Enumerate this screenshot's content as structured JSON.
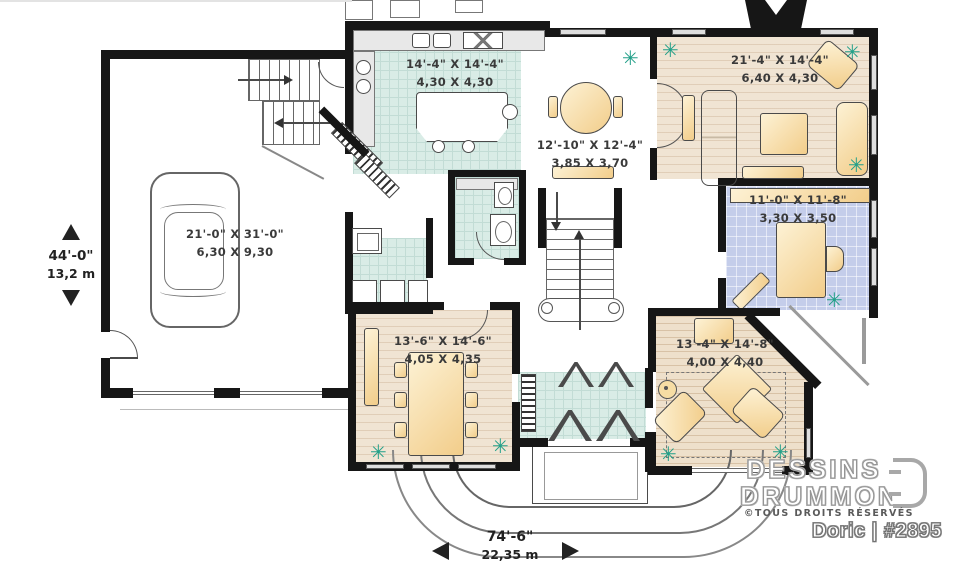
{
  "icons": {
    "plant": "✳"
  },
  "plan": {
    "rooms": [
      {
        "name": "garage",
        "imperial": "21'-0\" X 31'-0\"",
        "metric": "6,30 X 9,30"
      },
      {
        "name": "kitchen",
        "imperial": "14'-4\" X 14'-4\"",
        "metric": "4,30 X 4,30"
      },
      {
        "name": "breakfast",
        "imperial": "12'-10\" X 12'-4\"",
        "metric": "3,85 X 3,70"
      },
      {
        "name": "living",
        "imperial": "21'-4\" X 14'-4\"",
        "metric": "6,40 X 4,30"
      },
      {
        "name": "office",
        "imperial": "11'-0\" X 11'-8\"",
        "metric": "3,30 X 3,50"
      },
      {
        "name": "dining",
        "imperial": "13'-6\" X 14'-6\"",
        "metric": "4,05 X 4,35"
      },
      {
        "name": "family",
        "imperial": "13'-4\" X 14'-8\"",
        "metric": "4,00 X 4,40"
      }
    ],
    "overall": {
      "depth_imperial": "44'-0\"",
      "depth_metric": "13,2 m",
      "width_imperial": "74'-6\"",
      "width_metric": "22,35 m"
    }
  },
  "branding": {
    "brand_line1": "DESSINS",
    "brand_line2": "DRUMMOND",
    "rights": "©TOUS DROITS RÉSERVÉS",
    "plan_title": "Doric | #2895"
  },
  "colors": {
    "wall": "#161616",
    "tile_floor": "#d9ece6",
    "wood_floor": "#f0e4d3",
    "office_floor": "#c4cdea",
    "furniture": "#f2cd8a",
    "plant": "#23a089"
  }
}
